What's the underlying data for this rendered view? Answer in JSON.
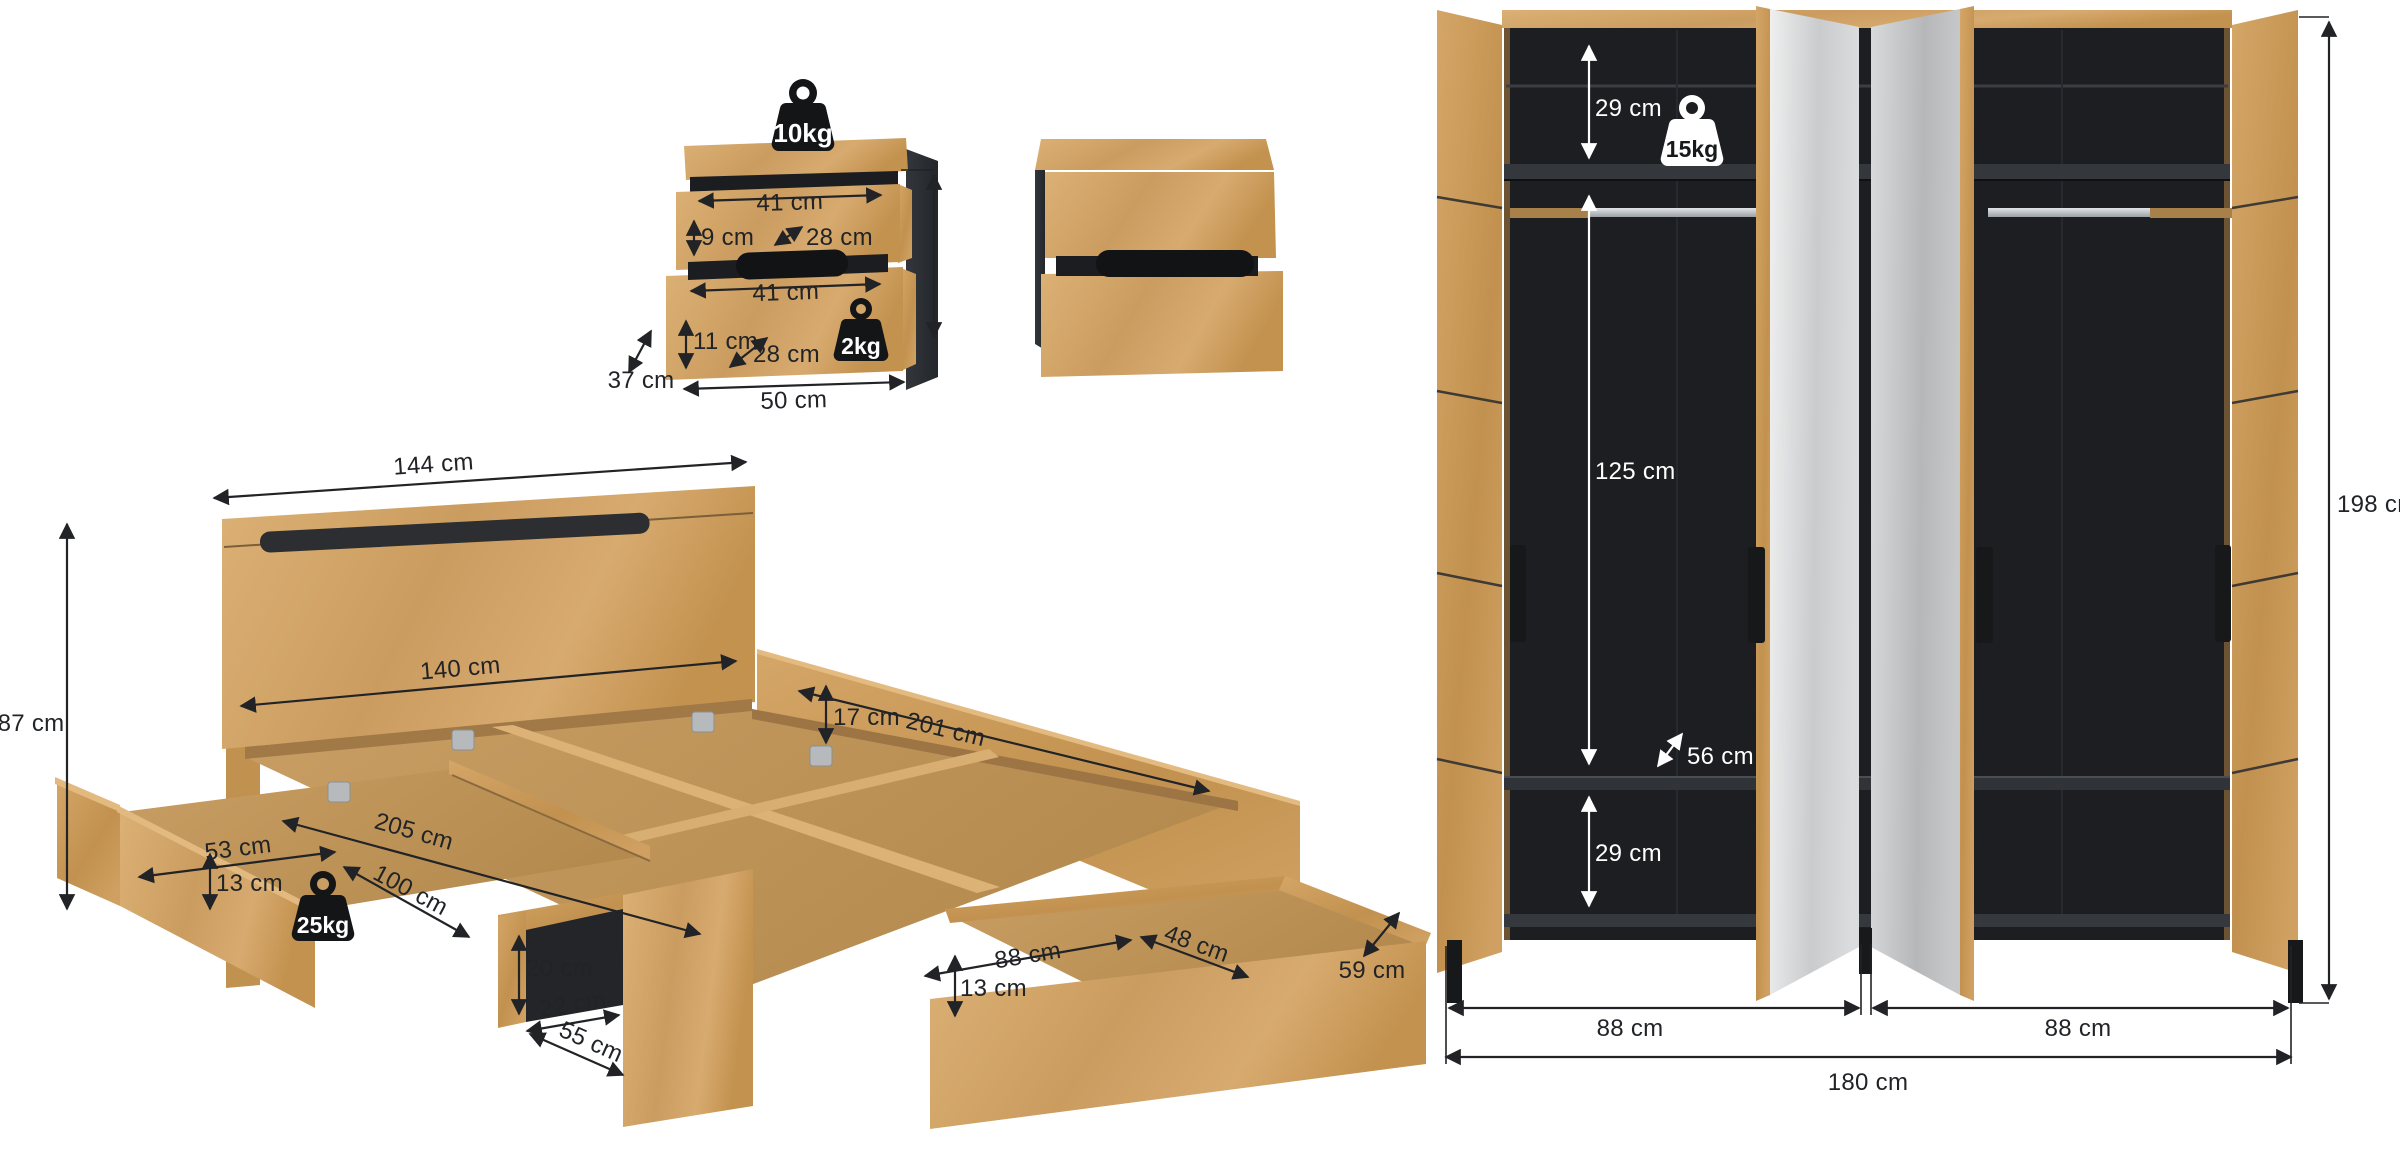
{
  "page": {
    "background": "#ffffff"
  },
  "colors": {
    "wood": "#d2a569",
    "wood_dark": "#b98c52",
    "side_panel_dark": "#2b2e33",
    "wardrobe_interior": "#1c1e21",
    "mirror": "#d7d9db",
    "dimension_line": "#212326",
    "dimension_line_on_dark": "#ffffff",
    "weight_badge_black": "#141517",
    "weight_badge_white": "#ffffff"
  },
  "nightstand_open": {
    "max_load_top": "10kg",
    "max_load_drawer": "2kg",
    "drawer_top": {
      "width": "41 cm",
      "height": "9 cm",
      "depth": "28 cm"
    },
    "drawer_bottom": {
      "width": "41 cm",
      "height": "11 cm",
      "depth": "28 cm"
    },
    "width": "50 cm",
    "depth": "37 cm"
  },
  "bed": {
    "headboard_width": "144 cm",
    "headboard_height": "87 cm",
    "inner_width": "140 cm",
    "frame_height": "17 cm",
    "inner_length": "201 cm",
    "length": "205 cm",
    "depth": "59 cm",
    "underbed_clearance": "20 cm",
    "footboard_niche_width": "22 cm",
    "footboard_niche_depth": "55 cm",
    "side_drawer": {
      "width": "53 cm",
      "height": "13 cm",
      "length": "100 cm",
      "max_load": "25kg"
    },
    "foot_drawer": {
      "width": "88 cm",
      "height": "13 cm",
      "depth": "48 cm"
    }
  },
  "wardrobe": {
    "max_load_shelf": "15kg",
    "top_section_height": "29 cm",
    "hanging_section_height": "125 cm",
    "depth": "56 cm",
    "bottom_section_height": "29 cm",
    "height": "198 cm",
    "left_section_width": "88 cm",
    "right_section_width": "88 cm",
    "width": "180 cm"
  }
}
